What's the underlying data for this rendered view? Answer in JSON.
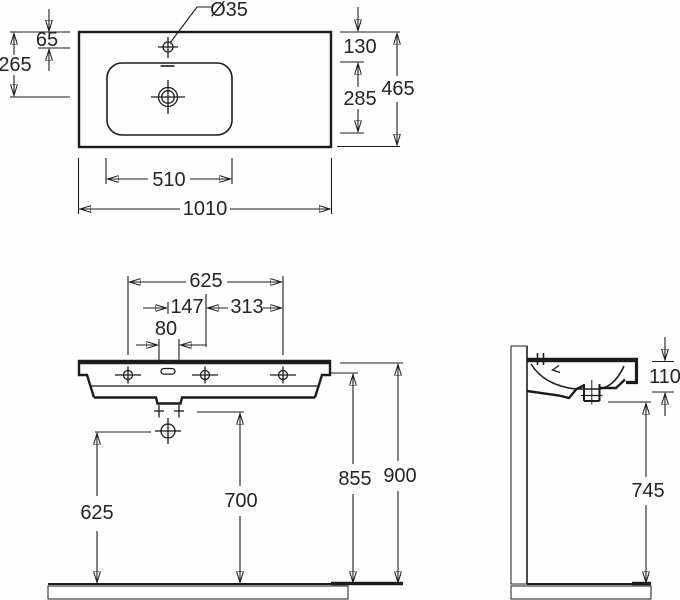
{
  "top_view": {
    "faucet_hole_diameter": "Ø35",
    "faucet_offset": "65",
    "drain_offset": "265",
    "edge_to_bowl": "130",
    "bowl_depth": "285",
    "overall_depth": "465",
    "bowl_width": "510",
    "overall_width": "1010"
  },
  "front_view": {
    "hole_span": "625",
    "slot_to_center": "147",
    "center_to_hole": "313",
    "slot_width": "80",
    "trap_height": "625",
    "drain_height": "700",
    "underside_height": "855",
    "rim_height": "900"
  },
  "side_view": {
    "basin_height": "110",
    "clearance_height": "745"
  }
}
